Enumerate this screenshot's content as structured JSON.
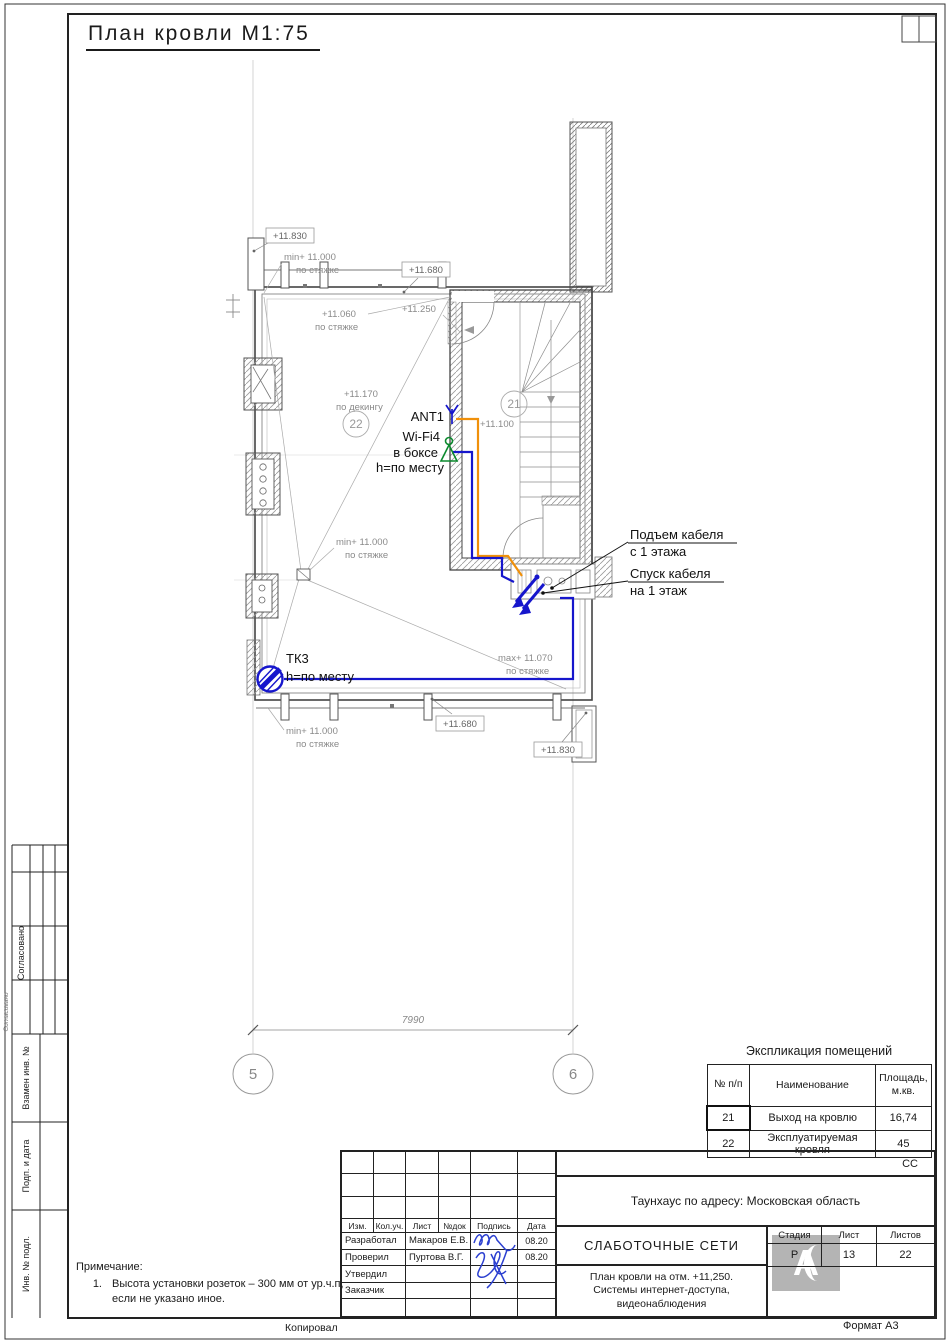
{
  "sheet": {
    "title": "План кровли М1:75"
  },
  "plan": {
    "labels": {
      "elev_11830": "+11.830",
      "elev_11680": "+11.680",
      "elev_11250": "+11.250",
      "elev_11060": "+11.060",
      "elev_11170": "+11.170",
      "elev_11100": "+11.100",
      "min_11000": "min+ 11.000",
      "max_11070": "max+ 11.070",
      "per_screed": "по стяжке",
      "per_decking": "по декингу",
      "room21": "21",
      "room22": "22",
      "ant": "ANT1",
      "wifi": "Wi-Fi4",
      "in_box": "в боксе",
      "h_note": "h=по месту",
      "tk": "ТК3",
      "cable_up1": "Подъем кабеля",
      "cable_up2": "с 1 этажа",
      "cable_down1": "Спуск кабеля",
      "cable_down2": "на 1 этаж",
      "dim": "7990",
      "axis5": "5",
      "axis6": "6"
    }
  },
  "explication": {
    "title": "Экспликация помещений",
    "col1": "№ п/п",
    "col2": "Наименование",
    "col3a": "Площадь,",
    "col3b": "м.кв.",
    "rows": [
      [
        "21",
        "Выход на кровлю",
        "16,74"
      ],
      [
        "22",
        "Эксплуатируемая кровля",
        "45"
      ]
    ]
  },
  "titleblock": {
    "cc": "СС",
    "address": "Таунхаус по адресу: Московская область",
    "cols": {
      "izm": "Изм.",
      "koluch": "Кол.уч.",
      "list": "Лист",
      "ndok": "№док",
      "podpis": "Подпись",
      "data": "Дата"
    },
    "rows": [
      {
        "role": "Разработал",
        "name": "Макаров Е.В.",
        "date": "08.20"
      },
      {
        "role": "Проверил",
        "name": "Пуртова В.Г.",
        "date": "08.20"
      },
      {
        "role": "Утвердил",
        "name": "",
        "date": ""
      },
      {
        "role": "Заказчик",
        "name": "",
        "date": ""
      }
    ],
    "project": "СЛАБОТОЧНЫЕ СЕТИ",
    "desc_lines": [
      "План кровли на отм. +11,250.",
      "Системы интернет-доступа,",
      "видеонаблюдения"
    ],
    "stage_label": "Стадия",
    "sheet_label": "Лист",
    "sheets_label": "Листов",
    "stage": "Р",
    "sheet": "13",
    "sheets": "22",
    "logo": "А"
  },
  "margin": {
    "approved": "Согласовано",
    "replace_inv": "Взамен инв. №",
    "sign_date": "Подп. и дата",
    "inv_no": "Инв. № подл."
  },
  "note": {
    "title": "Примечание:",
    "num": "1.",
    "line1": "Высота установки розеток – 300 мм от ур.ч.п,",
    "line2": "если не указано иное."
  },
  "footer": {
    "copied": "Копировал",
    "format": "Формат А3"
  },
  "colors": {
    "cable_orange": "#f0900a",
    "cable_blue": "#1616cc",
    "wifi_green": "#0c8a2e",
    "signature_blue": "#2b3fd0"
  }
}
